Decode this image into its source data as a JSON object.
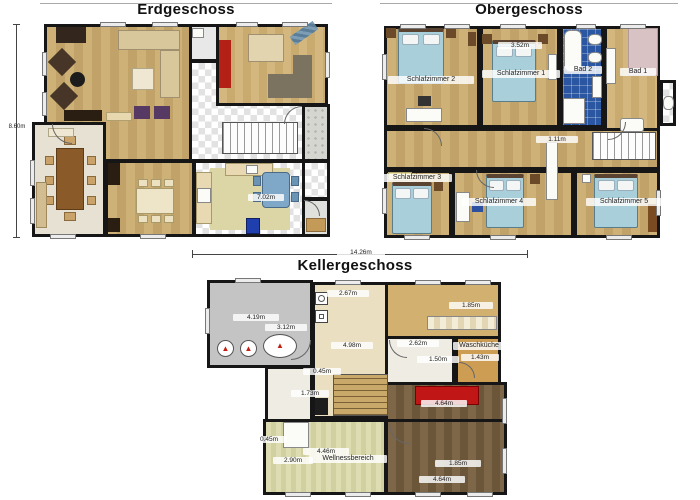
{
  "eg": {
    "title": "Erdgeschoss",
    "dims": {
      "height": "8.60m",
      "kitchen": "7.02m"
    }
  },
  "og": {
    "title": "Obergeschoss",
    "rooms": {
      "sz1": "Schlafzimmer 1",
      "sz2": "Schlafzimmer 2",
      "sz3": "Schlafzimmer 3",
      "sz4": "Schlafzimmer 4",
      "sz5": "Schlafzimmer 5",
      "bad1": "Bad 1",
      "bad2": "Bad 2"
    },
    "dims": {
      "sz1_w": "3.52m",
      "hall": "1.11m"
    }
  },
  "kg": {
    "title": "Kellergeschoss",
    "rooms": {
      "wasch": "Waschküche",
      "wellness": "Wellnessbereich"
    },
    "dims": {
      "total": "14.26m",
      "boiler_w": "4.19m",
      "boiler_h": "3.12m",
      "mid_w": "2.67m",
      "mid_h": "4.98m",
      "stair_a": "0.45m",
      "stair_b": "1.73m",
      "tan_w": "1.85m",
      "white_w": "2.62m",
      "white_h": "1.50m",
      "wasch_w": "1.43m",
      "red_w": "4.64m",
      "dark_a": "1.85m",
      "dark_b": "4.64m",
      "well_a": "4.46m",
      "well_b": "2.90m",
      "well_c": "0.45m"
    }
  },
  "icons": {
    "flame": "▲"
  }
}
